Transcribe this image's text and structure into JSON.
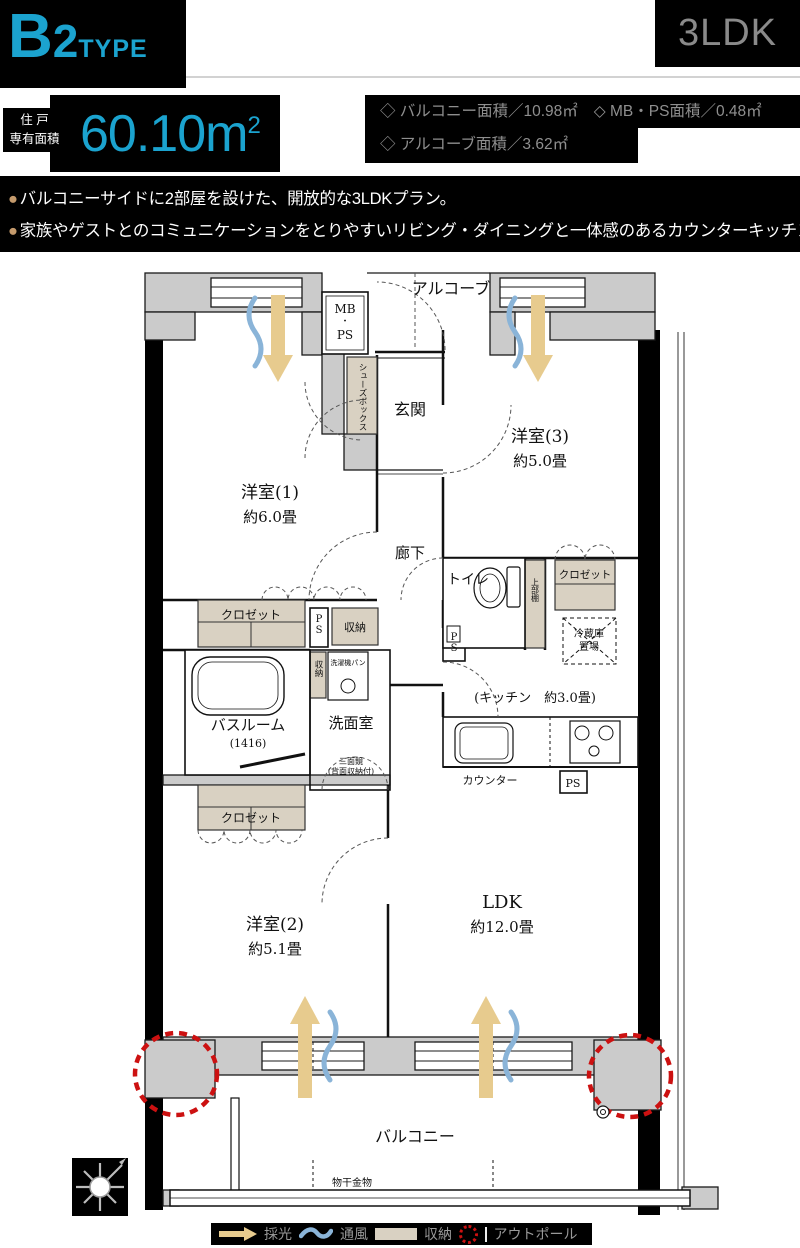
{
  "header": {
    "type_code": "B2",
    "type_suffix": "TYPE",
    "layout": "3LDK",
    "area_label_line1": "住 戸",
    "area_label_line2": "専有面積",
    "area_value": "60.10m",
    "area_sup": "2",
    "details": {
      "line1a": "◇ バルコニー面積／10.98㎡",
      "line1b": "◇ MB・PS面積／0.48㎡",
      "line2": "◇ アルコーブ面積／3.62㎡"
    }
  },
  "features": {
    "bullet": "●",
    "items": [
      "バルコニーサイドに2部屋を設けた、開放的な3LDKプラン。",
      "家族やゲストとのコミュニケーションをとりやすいリビング・ダイニングと一体感のあるカウンターキッチン。"
    ]
  },
  "plan": {
    "alcove": "アルコーブ",
    "mbps": [
      "MB",
      "・",
      "PS"
    ],
    "shoes_box": "シューズボックス",
    "genkan": "玄関",
    "hallway": "廊下",
    "room1": {
      "name": "洋室(1)",
      "size": "約6.0畳"
    },
    "room3": {
      "name": "洋室(3)",
      "size": "約5.0畳"
    },
    "room2": {
      "name": "洋室(2)",
      "size": "約5.1畳"
    },
    "ldk": {
      "name": "LDK",
      "size": "約12.0畳"
    },
    "kitchen": "(キッチン　約3.0畳)",
    "toilet": "トイレ",
    "upper_shelf": "上部棚",
    "closet": "クロゼット",
    "storage": "収納",
    "ps": "PS",
    "washer_pan": "洗濯機パン",
    "bathroom": {
      "name": "バスルーム",
      "size": "(1416)"
    },
    "washroom": "洗面室",
    "mirror_line1": "三面鏡",
    "mirror_line2": "(背面収納付)",
    "fridge_line1": "冷蔵庫",
    "fridge_line2": "置場",
    "counter": "カウンター",
    "balcony": "バルコニー",
    "laundry": "物干金物"
  },
  "legend": {
    "daylight": "採光",
    "ventilation": "通風",
    "storage": "収納",
    "outpole": "アウトポール"
  },
  "colors": {
    "accent": "#1ba3cf",
    "bullet_dot": "#c49a6c",
    "arrow": "#e7cb8e",
    "wave": "#8ab4d8",
    "beige": "#d9d1c2",
    "wall": "#cbcbcb",
    "red": "#cc1111",
    "muted_text": "#8f8f8f"
  }
}
